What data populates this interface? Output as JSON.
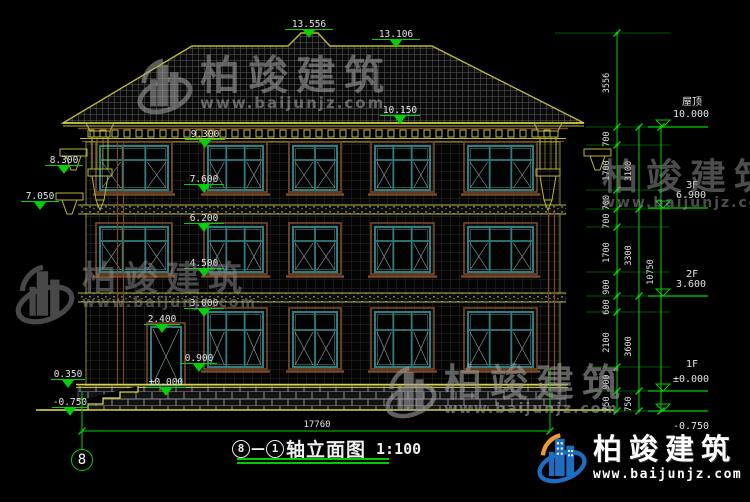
{
  "colors": {
    "green": "#00d400",
    "yellow": "#b9b92e",
    "yellow_bright": "#d6d63a",
    "teal": "#2e8080",
    "brown": "#7a4a28",
    "white": "#e2e2e2",
    "logo_blue": "#1b6ec2",
    "logo_orange": "#f09b2a"
  },
  "title": {
    "bubble_left": "8",
    "dash": "—",
    "bubble_right": "1",
    "text": "轴立面图",
    "scale": "1:100"
  },
  "axis_bubble": "8",
  "bottom_dim": {
    "value": "17760",
    "x": 317,
    "y": 427,
    "line_y": 431,
    "x1": 82,
    "x2": 550
  },
  "elevation_markers": [
    {
      "t": "13.556",
      "x": 309,
      "y": 27,
      "lw": 48
    },
    {
      "t": "13.106",
      "x": 396,
      "y": 37,
      "lw": 48
    },
    {
      "t": "10.150",
      "x": 400,
      "y": 113,
      "lw": 40
    },
    {
      "t": "9.300",
      "x": 205,
      "y": 137,
      "lw": 40
    },
    {
      "t": "8.300",
      "x": 64,
      "y": 163,
      "lw": 38
    },
    {
      "t": "7.600",
      "x": 204,
      "y": 182,
      "lw": 40
    },
    {
      "t": "7.050",
      "x": 40,
      "y": 199,
      "lw": 38
    },
    {
      "t": "6.200",
      "x": 204,
      "y": 221,
      "lw": 40
    },
    {
      "t": "4.500",
      "x": 204,
      "y": 266,
      "lw": 40
    },
    {
      "t": "3.000",
      "x": 204,
      "y": 306,
      "lw": 40
    },
    {
      "t": "2.400",
      "x": 162,
      "y": 322,
      "lw": 36
    },
    {
      "t": "0.900",
      "x": 199,
      "y": 361,
      "lw": 36
    },
    {
      "t": "±0.000",
      "x": 166,
      "y": 385,
      "lw": 40
    },
    {
      "t": "0.350",
      "x": 68,
      "y": 377,
      "lw": 34
    },
    {
      "t": "-0.750",
      "x": 70,
      "y": 405,
      "lw": 36
    }
  ],
  "floor_markers": [
    {
      "label": "屋顶",
      "value": "10.000",
      "label_y": 105,
      "value_y": 117,
      "line_y": 127
    },
    {
      "label": "3F",
      "value": "6.900",
      "label_y": 188,
      "value_y": 198,
      "line_y": 208
    },
    {
      "label": "2F",
      "value": "3.600",
      "label_y": 277,
      "value_y": 287,
      "line_y": 296
    },
    {
      "label": "1F",
      "value": "±0.000",
      "label_y": 367,
      "value_y": 382,
      "line_y": 391
    },
    {
      "label": "",
      "value": "-0.750",
      "label_y": 0,
      "value_y": 429,
      "line_y": 411
    }
  ],
  "dim_chains": [
    {
      "x": 617,
      "label_x": 609,
      "ticks": [
        33,
        127,
        145,
        190,
        209,
        227,
        272,
        296,
        312,
        367,
        391,
        411
      ],
      "labels": [
        "3556",
        "700",
        "1700",
        "700",
        "700",
        "1700",
        "900",
        "600",
        "2100",
        "900",
        "750"
      ]
    },
    {
      "x": 639,
      "label_x": 631,
      "ticks": [
        127,
        209,
        296,
        391,
        411
      ],
      "labels": [
        "3100",
        "3300",
        "3600",
        "750"
      ]
    },
    {
      "x": 661,
      "label_x": 653,
      "ticks": [
        127,
        411
      ],
      "labels": [
        "10750"
      ]
    }
  ],
  "watermark": {
    "brand": "柏竣建筑",
    "url": "www.baijunjz.com"
  },
  "watermark_positions": [
    {
      "x": 136,
      "y": 56,
      "icon": true,
      "icon_size": 58,
      "font": 40,
      "url_font": 15,
      "color": "#a8a8a8",
      "opacity": 0.55
    },
    {
      "x": 596,
      "y": 160,
      "icon": false,
      "icon_size": 0,
      "font": 36,
      "url_font": 14,
      "color": "#9a9a9a",
      "opacity": 0.5
    },
    {
      "x": 14,
      "y": 262,
      "icon": true,
      "icon_size": 62,
      "font": 34,
      "url_font": 14,
      "color": "#8f8f8f",
      "opacity": 0.5
    },
    {
      "x": 384,
      "y": 364,
      "icon": true,
      "icon_size": 54,
      "font": 38,
      "url_font": 14,
      "color": "#9e9e9e",
      "opacity": 0.6
    }
  ],
  "footer_logo": {
    "brand": "柏竣建筑",
    "url": "www.baijunjz.com"
  },
  "building": {
    "roof_outline": [
      [
        63,
        123
      ],
      [
        192,
        46
      ],
      [
        288,
        46
      ],
      [
        301,
        33
      ],
      [
        318,
        33
      ],
      [
        330,
        46
      ],
      [
        432,
        46
      ],
      [
        584,
        123
      ]
    ],
    "eave": {
      "x1": 63,
      "x2": 584,
      "y": 123
    },
    "cornice": {
      "x1": 80,
      "x2": 566,
      "dentil_y": 130
    },
    "wall": {
      "x1": 86,
      "y1": 142,
      "x2": 560,
      "y2": 386
    },
    "bands": [
      {
        "y1": 205,
        "y2": 214
      },
      {
        "y1": 293,
        "y2": 302
      }
    ],
    "plinth": {
      "x1": 78,
      "x2": 566,
      "y1": 386,
      "y2": 410
    },
    "ground": {
      "x1": 36,
      "x2": 614,
      "y": 410
    },
    "steps": [
      [
        138,
        386
      ],
      [
        138,
        392
      ],
      [
        120,
        392
      ],
      [
        120,
        398
      ],
      [
        103,
        398
      ],
      [
        103,
        404
      ],
      [
        88,
        404
      ],
      [
        88,
        410
      ],
      [
        40,
        410
      ]
    ],
    "windows": [
      {
        "x": 100,
        "y": 146,
        "w": 68,
        "h": 44,
        "cols": 3
      },
      {
        "x": 208,
        "y": 146,
        "w": 55,
        "h": 44,
        "cols": 3
      },
      {
        "x": 293,
        "y": 146,
        "w": 44,
        "h": 44,
        "cols": 2
      },
      {
        "x": 375,
        "y": 146,
        "w": 55,
        "h": 44,
        "cols": 3
      },
      {
        "x": 468,
        "y": 146,
        "w": 65,
        "h": 44,
        "cols": 3
      },
      {
        "x": 100,
        "y": 227,
        "w": 68,
        "h": 45,
        "cols": 3
      },
      {
        "x": 208,
        "y": 227,
        "w": 55,
        "h": 45,
        "cols": 3
      },
      {
        "x": 293,
        "y": 227,
        "w": 44,
        "h": 45,
        "cols": 2
      },
      {
        "x": 375,
        "y": 227,
        "w": 55,
        "h": 45,
        "cols": 3
      },
      {
        "x": 468,
        "y": 227,
        "w": 65,
        "h": 45,
        "cols": 3
      },
      {
        "x": 208,
        "y": 312,
        "w": 55,
        "h": 55,
        "cols": 3
      },
      {
        "x": 293,
        "y": 312,
        "w": 44,
        "h": 55,
        "cols": 2
      },
      {
        "x": 375,
        "y": 312,
        "w": 55,
        "h": 55,
        "cols": 3
      },
      {
        "x": 468,
        "y": 312,
        "w": 65,
        "h": 55,
        "cols": 3
      }
    ],
    "door": {
      "x": 151,
      "y": 327,
      "w": 30,
      "h": 59
    },
    "columns": [
      {
        "cx": 100
      },
      {
        "cx": 548
      }
    ],
    "side_brackets": [
      {
        "x": 60,
        "y": 149
      },
      {
        "x": 56,
        "y": 193
      },
      {
        "x": 584,
        "y": 149
      }
    ],
    "pipes": [
      {
        "x": 117.5,
        "y1": 142,
        "y2": 384
      },
      {
        "x": 548.5,
        "y1": 210,
        "y2": 384
      }
    ]
  }
}
